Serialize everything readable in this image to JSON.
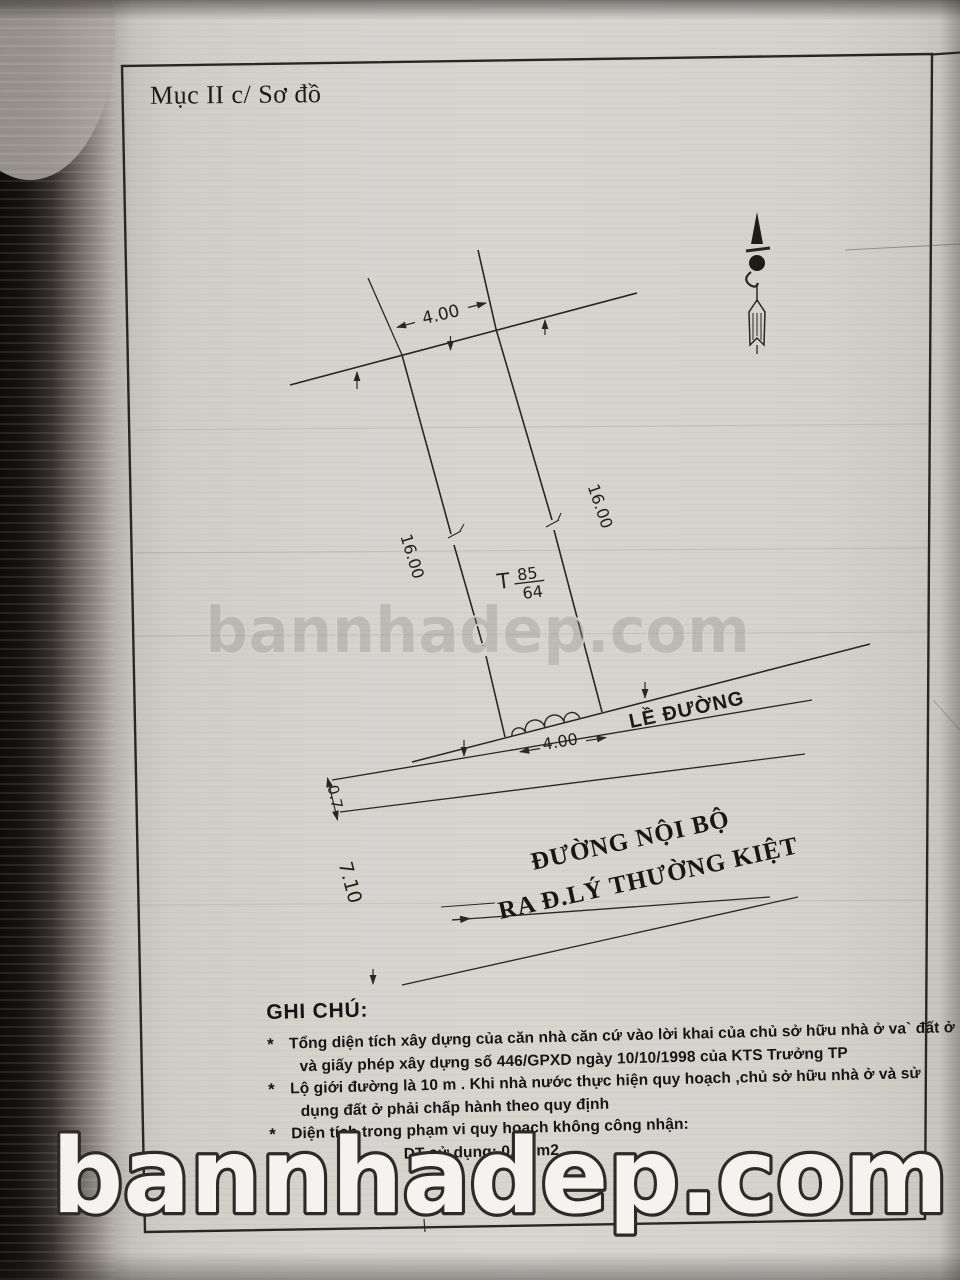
{
  "colors": {
    "ink": "#2a2722",
    "paper": "#d6d3cf"
  },
  "title": {
    "text": "Mục II c/ Sơ đồ"
  },
  "diagram": {
    "dim_top_width": "4.00",
    "dim_left_depth": "16.00",
    "dim_right_depth": "16.00",
    "dim_front_width": "4.00",
    "dim_sidewalk_width": "0.7",
    "dim_road_width": "7.10",
    "parcel": {
      "prefix": "T",
      "numerator": "85",
      "denominator": "64"
    },
    "sidewalk_label": "LỀ ĐƯỜNG",
    "road_line1": "ĐƯỜNG NỘI BỘ",
    "road_line2": "RA Đ.LÝ THƯỜNG KIỆT"
  },
  "notes": {
    "heading": "GHI CHÚ:",
    "items": [
      {
        "bullet": "*",
        "text": "Tổng diện tích xây dựng của căn nhà căn cứ vào lời khai của chủ sở hữu nhà ở va` đất ở"
      },
      {
        "bullet": "",
        "text": "và giấy phép xây dựng số 446/GPXD ngày 10/10/1998 của KTS Trưởng TP"
      },
      {
        "bullet": "*",
        "text": "Lộ giới đường là 10 m . Khi nhà nước thực hiện quy hoạch ,chủ sở hữu nhà ở và sử"
      },
      {
        "bullet": "",
        "text": "dụng đất ở phải chấp hành theo quy định"
      },
      {
        "bullet": "*",
        "text": "Diện tích trong phạm vi quy hoạch không công nhận:"
      },
      {
        "bullet": "",
        "text": "DT sử dụng: 0,80 m2"
      }
    ]
  },
  "watermarks": {
    "center": "bannhadep.com",
    "bottom": "bannhadep.com"
  }
}
